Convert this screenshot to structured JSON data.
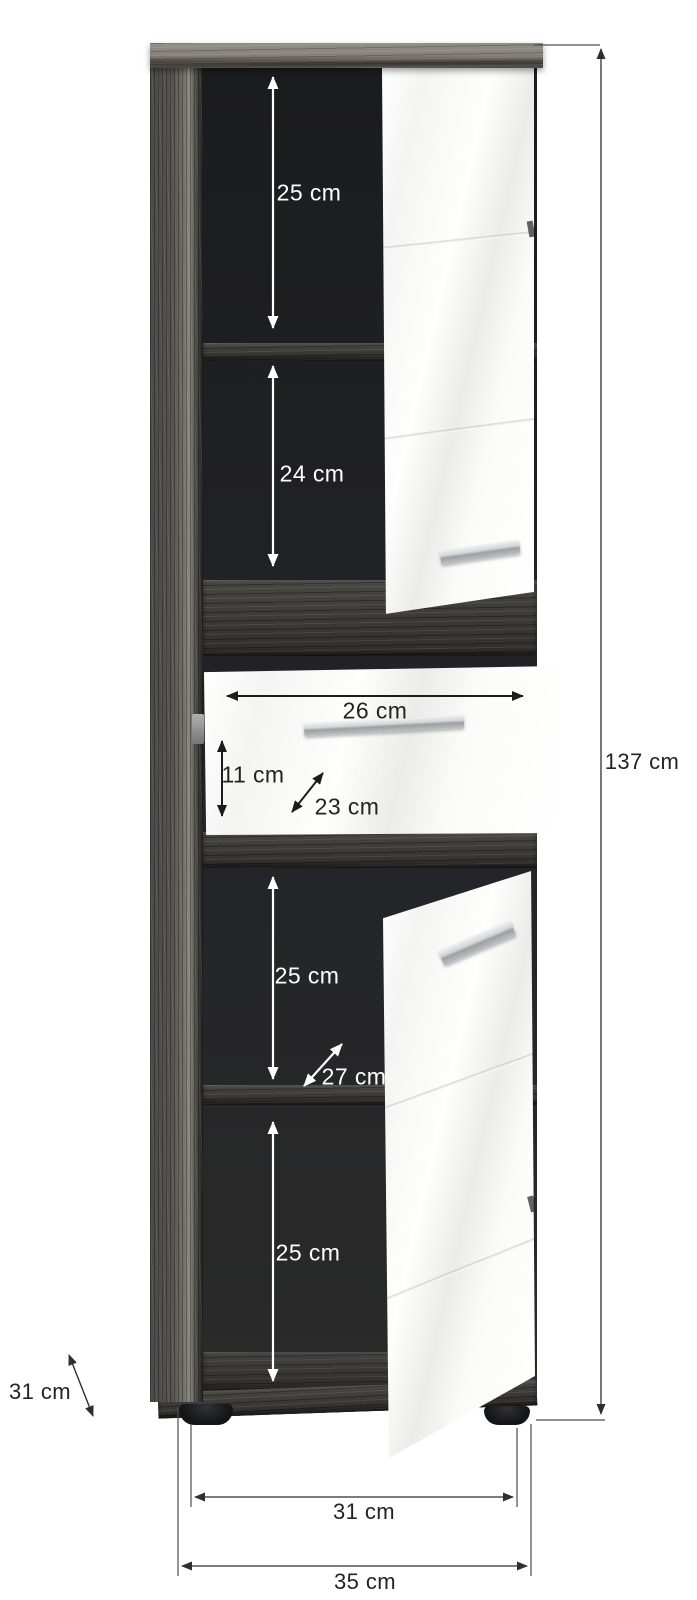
{
  "figure_type": "furniture-dimension-diagram",
  "annotations": {
    "top_shelf": "25 cm",
    "second_shelf": "24 cm",
    "drawer_width": "26 cm",
    "drawer_inner_height": "11 cm",
    "drawer_inner_depth": "23 cm",
    "third_shelf": "25 cm",
    "compartment_depth": "27 cm",
    "bottom_shelf": "25 cm",
    "total_height": "137 cm",
    "side_depth": "31 cm",
    "feet_span": "31 cm",
    "total_width": "35 cm"
  },
  "colors": {
    "wood_dark": "#3c3935",
    "wood_light_top": "#8b877f",
    "interior_black": "#232428",
    "door_white": "#fcfcfa",
    "handle_silver": "#c6c9cb",
    "annotation_white": "#ffffff",
    "annotation_black": "#232323"
  }
}
